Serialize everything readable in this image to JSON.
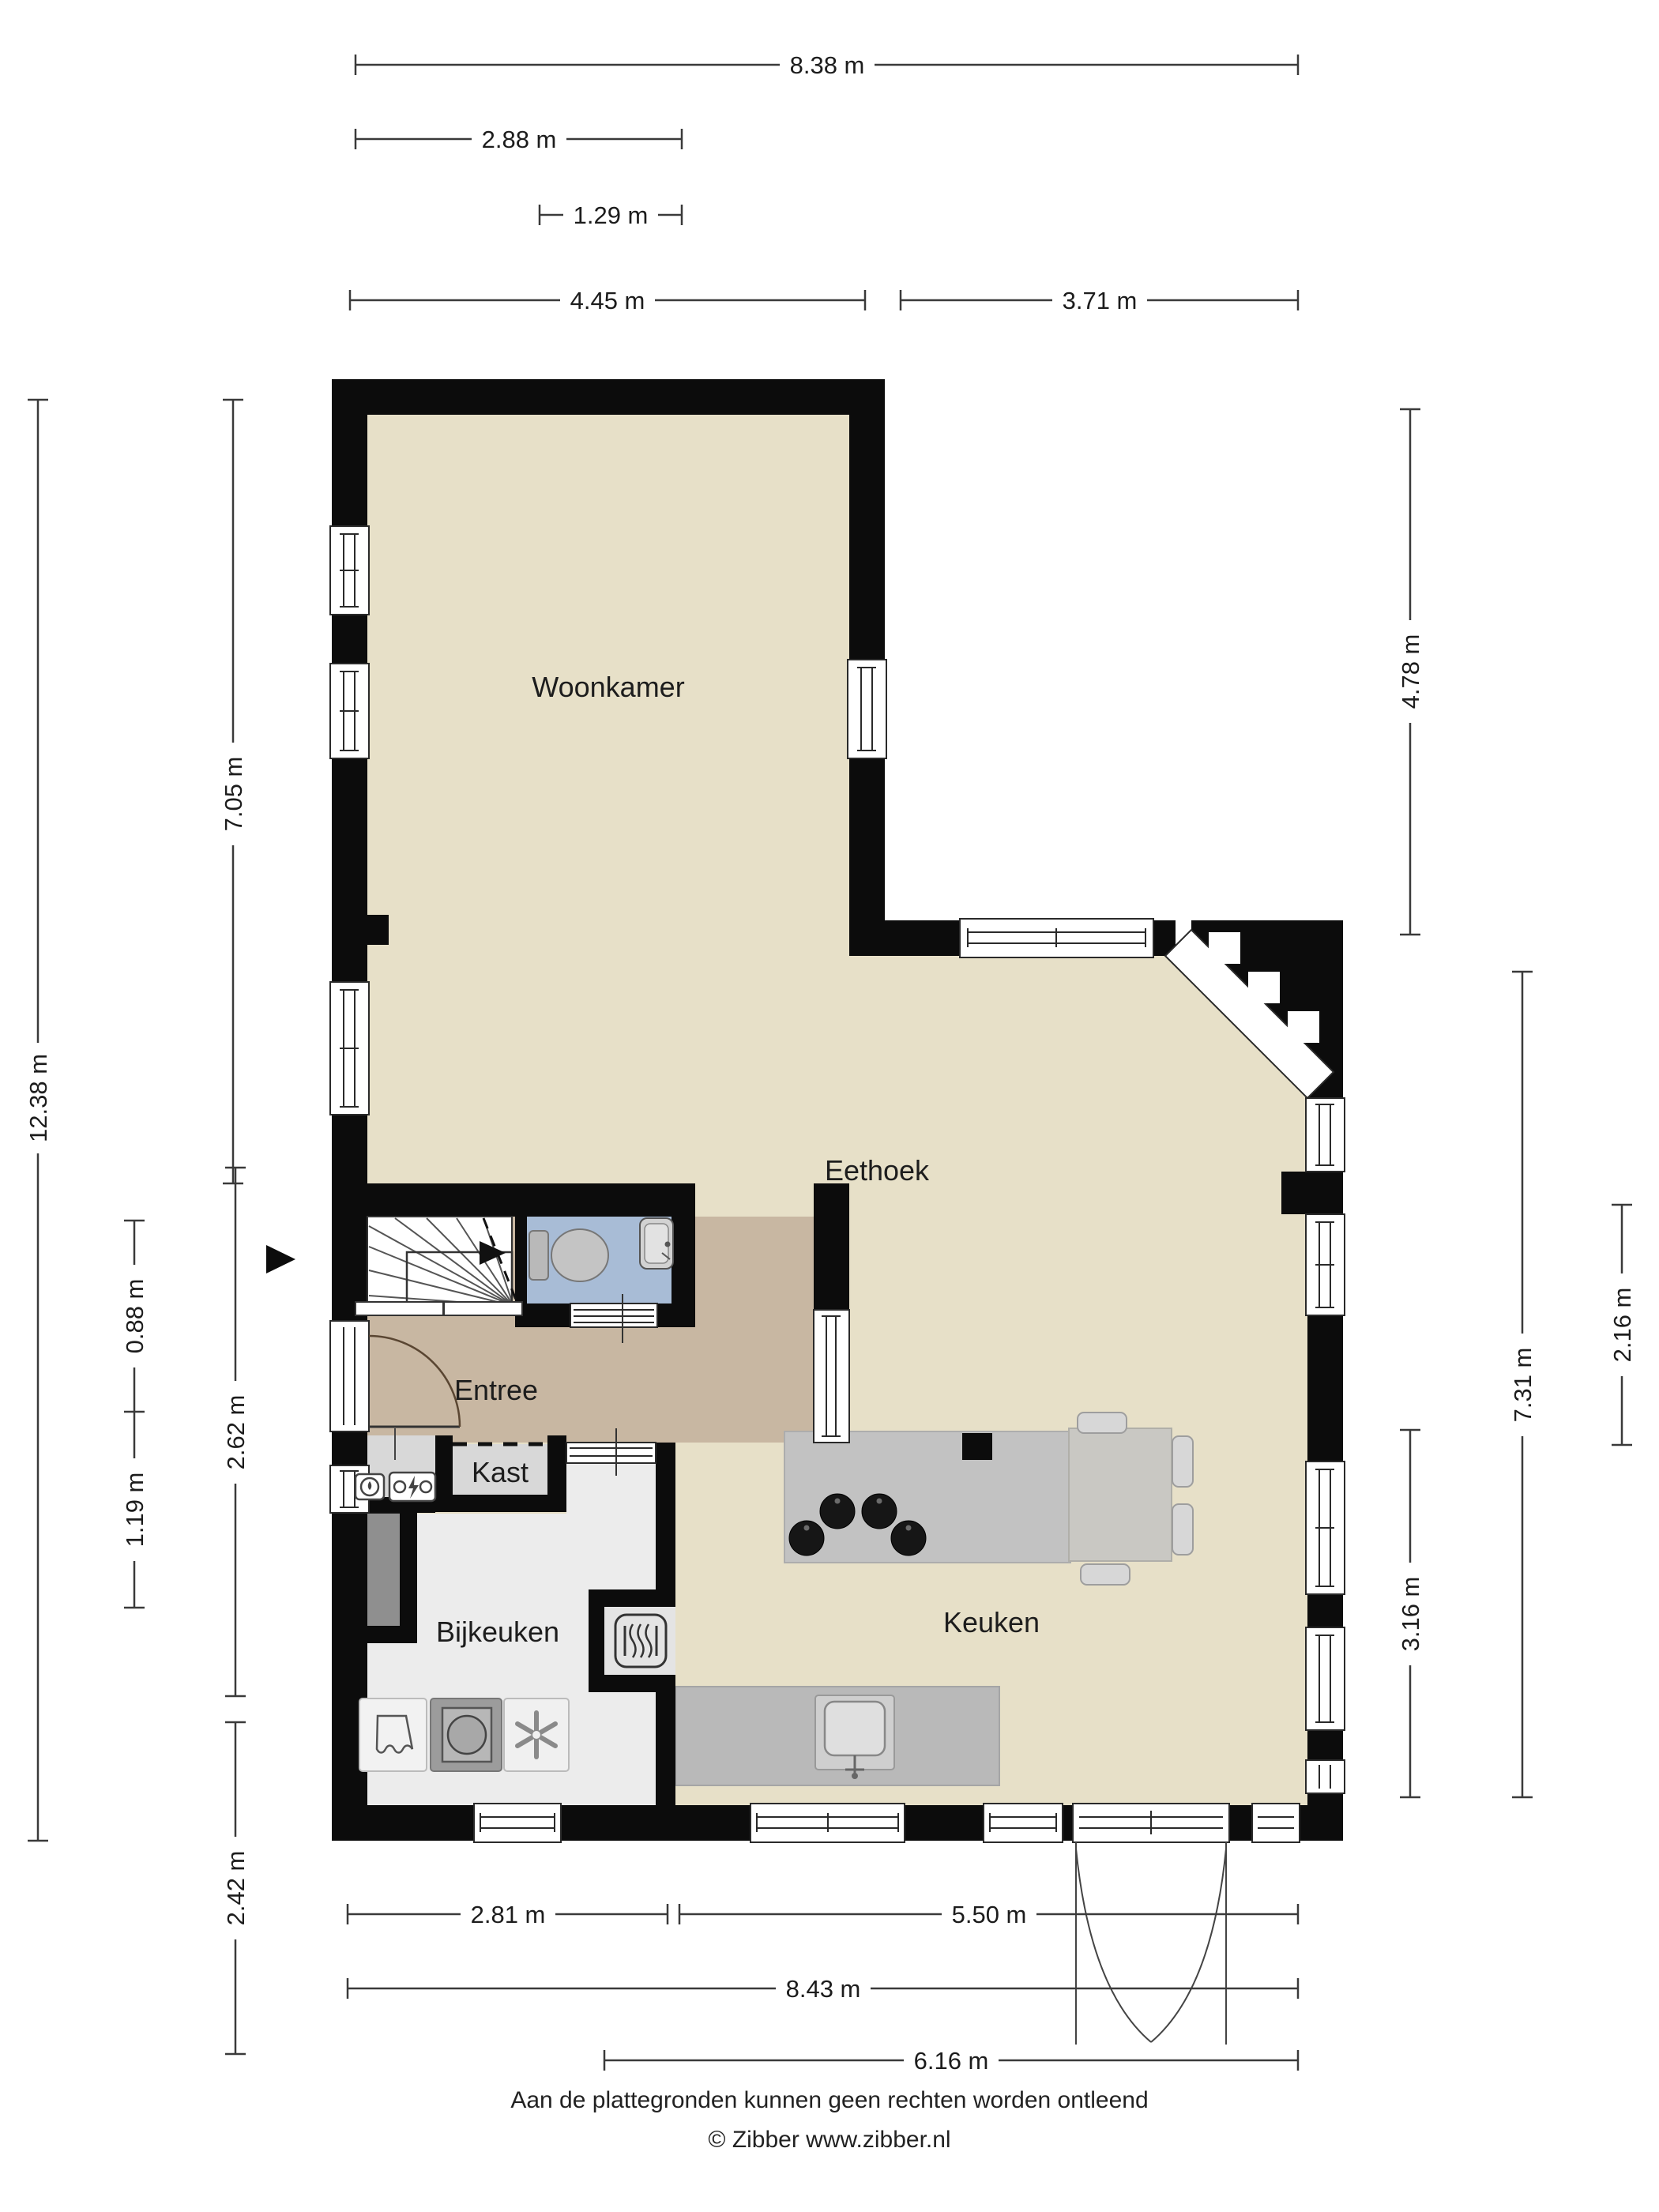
{
  "plan": {
    "type": "floorplan",
    "rooms": {
      "woonkamer": "Woonkamer",
      "eethoek": "Eethoek",
      "entree": "Entree",
      "kast": "Kast",
      "bijkeuken": "Bijkeuken",
      "keuken": "Keuken"
    },
    "colors": {
      "floor_main": "#e7e0c8",
      "floor_entree": "#c8b7a2",
      "floor_toilet": "#a8bcd6",
      "floor_kast": "#d8d8d8",
      "floor_bijkeuken": "#ececec",
      "floor_niche": "#e4e4e4",
      "island": "#c2c2c2",
      "table": "#c9c8c3",
      "counter": "#b9b9b9",
      "shaft": "#8f8f8f",
      "wall": "#0c0c0c"
    }
  },
  "dims": {
    "top": [
      "8.38 m",
      "2.88 m",
      "1.29 m",
      "4.45 m",
      "3.71 m"
    ],
    "bottom": [
      "2.81 m",
      "5.50 m",
      "8.43 m",
      "6.16 m"
    ],
    "left": [
      "12.38 m",
      "7.05 m",
      "0.88 m",
      "1.19 m",
      "2.62 m",
      "2.42 m"
    ],
    "right": [
      "4.78 m",
      "7.31 m",
      "2.16 m",
      "3.16 m"
    ]
  },
  "footer": {
    "disclaimer": "Aan de plattegronden kunnen geen rechten worden ontleend",
    "credit": "© Zibber www.zibber.nl"
  }
}
